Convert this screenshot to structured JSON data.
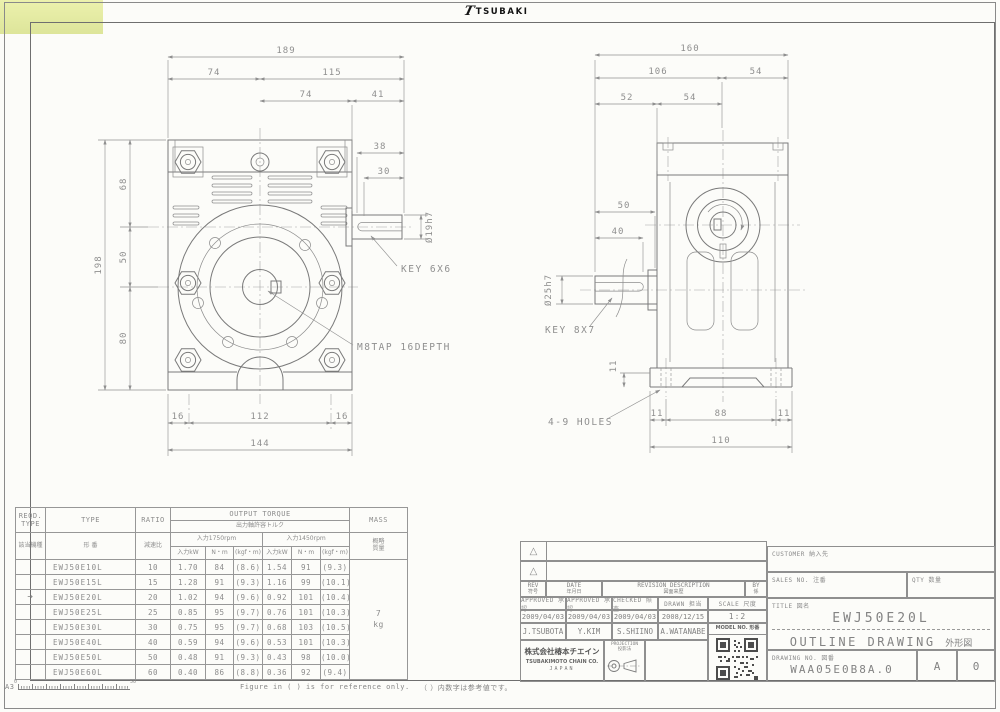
{
  "logo": {
    "mark": "T",
    "text": "TSUBAKI"
  },
  "left_view": {
    "dims": {
      "overall_w": "189",
      "top_left": "74",
      "top_right": "115",
      "mid_left": "74",
      "mid_right": "41",
      "d38": "38",
      "d30": "30",
      "height_total": "198",
      "h68": "68",
      "h50": "50",
      "h80": "80",
      "foot_l": "16",
      "foot_c": "112",
      "foot_r": "16",
      "foot_total": "144",
      "shaft_dia": "Ø19h7"
    },
    "labels": {
      "key": "KEY 6X6",
      "tap": "M8TAP 16DEPTH"
    }
  },
  "right_view": {
    "dims": {
      "overall_w": "160",
      "top_left": "106",
      "top_right": "54",
      "mid_left": "52",
      "mid_right": "54",
      "d50": "50",
      "d40": "40",
      "shaft_dia": "Ø25h7",
      "foot_l": "11",
      "foot_c": "88",
      "foot_r": "11",
      "foot_total": "110",
      "foot_h": "11"
    },
    "labels": {
      "key": "KEY 8X7",
      "holes": "4-9 HOLES"
    }
  },
  "torque_table": {
    "header": {
      "reqd_type_en": "REQD.\nTYPE",
      "reqd_type_ja": "該当機種",
      "type_en": "TYPE",
      "type_ja": "形  番",
      "ratio_en": "RATIO",
      "ratio_ja": "減速比",
      "output_torque_en": "OUTPUT TORQUE",
      "output_torque_ja": "出力軸許容トルク",
      "input_1750": "入力1750rpm",
      "input_1450": "入力1450rpm",
      "col_input_kw": "入力kW",
      "col_nm": "N・m",
      "col_kgfm": "(kgf・m)",
      "mass_en": "MASS",
      "mass_ja": "概略\n質量"
    },
    "rows": [
      {
        "marker": "",
        "model": "EWJ50E10L",
        "ratio": "10",
        "kw_1750": "1.70",
        "nm_1750": "84",
        "kgfm_1750": "(8.6)",
        "kw_1450": "1.54",
        "nm_1450": "91",
        "kgfm_1450": "(9.3)"
      },
      {
        "marker": "",
        "model": "EWJ50E15L",
        "ratio": "15",
        "kw_1750": "1.28",
        "nm_1750": "91",
        "kgfm_1750": "(9.3)",
        "kw_1450": "1.16",
        "nm_1450": "99",
        "kgfm_1450": "(10.1)"
      },
      {
        "marker": "→",
        "model": "EWJ50E20L",
        "ratio": "20",
        "kw_1750": "1.02",
        "nm_1750": "94",
        "kgfm_1750": "(9.6)",
        "kw_1450": "0.92",
        "nm_1450": "101",
        "kgfm_1450": "(10.4)"
      },
      {
        "marker": "",
        "model": "EWJ50E25L",
        "ratio": "25",
        "kw_1750": "0.85",
        "nm_1750": "95",
        "kgfm_1750": "(9.7)",
        "kw_1450": "0.76",
        "nm_1450": "101",
        "kgfm_1450": "(10.3)"
      },
      {
        "marker": "",
        "model": "EWJ50E30L",
        "ratio": "30",
        "kw_1750": "0.75",
        "nm_1750": "95",
        "kgfm_1750": "(9.7)",
        "kw_1450": "0.68",
        "nm_1450": "103",
        "kgfm_1450": "(10.5)"
      },
      {
        "marker": "",
        "model": "EWJ50E40L",
        "ratio": "40",
        "kw_1750": "0.59",
        "nm_1750": "94",
        "kgfm_1750": "(9.6)",
        "kw_1450": "0.53",
        "nm_1450": "101",
        "kgfm_1450": "(10.3)"
      },
      {
        "marker": "",
        "model": "EWJ50E50L",
        "ratio": "50",
        "kw_1750": "0.48",
        "nm_1750": "91",
        "kgfm_1750": "(9.3)",
        "kw_1450": "0.43",
        "nm_1450": "98",
        "kgfm_1450": "(10.0)"
      },
      {
        "marker": "",
        "model": "EWJ50E60L",
        "ratio": "60",
        "kw_1750": "0.40",
        "nm_1750": "86",
        "kgfm_1750": "(8.8)",
        "kw_1450": "0.36",
        "nm_1450": "92",
        "kgfm_1450": "(9.4)"
      }
    ],
    "mass_value": "7",
    "mass_unit": "kg"
  },
  "title_block": {
    "rev_marks": [
      "△",
      "△"
    ],
    "rev_en": "REV",
    "rev_ja": "符号",
    "date_en": "DATE",
    "date_ja": "年月日",
    "desc_en": "REVISION DESCRIPTION",
    "desc_ja": "図面来歴",
    "by_en": "BY",
    "by_ja": "係",
    "approved1_label": "APPROVED 承認",
    "approved2_label": "APPROVED 承認",
    "checked_label": "CHECKED 照査",
    "drawn_label": "DRAWN 担当",
    "scale_label": "SCALE 尺度",
    "approved1_date": "2009/04/03",
    "approved2_date": "2009/04/03",
    "checked_date": "2009/04/03",
    "drawn_date": "2008/12/15",
    "scale_value": "1:2",
    "approved1_name": "J.TSUBOTA",
    "approved2_name": "Y.KIM",
    "checked_name": "S.SHIINO",
    "drawn_name": "A.WATANABE",
    "model_no_label": "MODEL NO. 形番",
    "company_ja": "株式会社椿本チエイン",
    "company_en": "TSUBAKIMOTO CHAIN CO.",
    "company_country": "JAPAN",
    "projection_en": "PROJECTION",
    "projection_ja": "投影法",
    "customer_label": "CUSTOMER 納入先",
    "sales_no_label": "SALES NO. 注番",
    "qty_label": "QTY 数量",
    "title_label": "TITLE 図名",
    "model": "EWJ50E20L",
    "drawing_title_en": "OUTLINE DRAWING",
    "drawing_title_ja": "外形図",
    "drawing_no_label": "DRAWING NO. 図番",
    "drawing_no": "WAA05E0B8A.0",
    "sheet_rev_letter": "A",
    "sheet_rev_number": "0"
  },
  "footer": {
    "sheet_size": "A3",
    "ruler_zero": "0",
    "ruler_fifty": "50",
    "note_en": "Figure in ( ) is for reference only.",
    "note_ja": "（ ）内数字は参考値です。"
  }
}
